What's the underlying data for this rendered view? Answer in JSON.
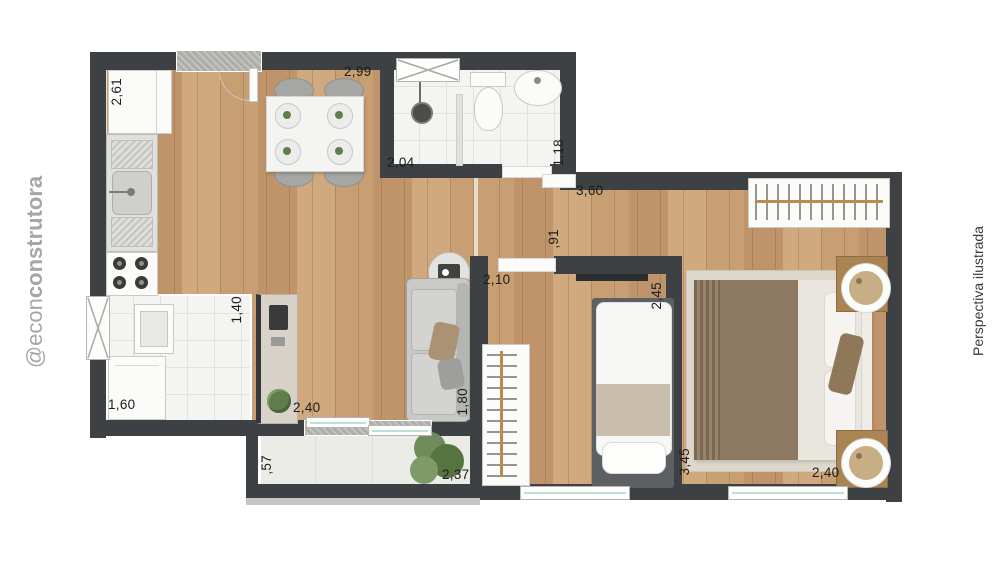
{
  "watermarks": {
    "left": {
      "prefix": "@econ",
      "bold": "construtora"
    },
    "right": "Perspectiva ilustrada"
  },
  "dimension_labels": [
    {
      "label": "2,61",
      "x": 109,
      "y": 78,
      "orientation": "vertical"
    },
    {
      "label": "2,99",
      "x": 344,
      "y": 64,
      "orientation": "horizontal"
    },
    {
      "label": "2,04",
      "x": 387,
      "y": 155,
      "orientation": "horizontal"
    },
    {
      "label": "1,18",
      "x": 551,
      "y": 139,
      "orientation": "vertical"
    },
    {
      "label": "3,60",
      "x": 576,
      "y": 183,
      "orientation": "horizontal"
    },
    {
      "label": ",91",
      "x": 546,
      "y": 229,
      "orientation": "vertical"
    },
    {
      "label": "2,10",
      "x": 483,
      "y": 272,
      "orientation": "horizontal"
    },
    {
      "label": "2,45",
      "x": 649,
      "y": 282,
      "orientation": "vertical"
    },
    {
      "label": "1,40",
      "x": 229,
      "y": 296,
      "orientation": "vertical"
    },
    {
      "label": "1,60",
      "x": 108,
      "y": 397,
      "orientation": "horizontal"
    },
    {
      "label": "2,40",
      "x": 293,
      "y": 400,
      "orientation": "horizontal"
    },
    {
      "label": "1,80",
      "x": 455,
      "y": 388,
      "orientation": "vertical"
    },
    {
      "label": ",57",
      "x": 259,
      "y": 455,
      "orientation": "vertical"
    },
    {
      "label": "2,37",
      "x": 442,
      "y": 467,
      "orientation": "horizontal"
    },
    {
      "label": "3,45",
      "x": 677,
      "y": 448,
      "orientation": "vertical"
    },
    {
      "label": "2,40",
      "x": 812,
      "y": 465,
      "orientation": "horizontal"
    }
  ],
  "colors": {
    "wall": "#3e4144",
    "wood_floor": "#c79f72",
    "tile_floor": "#f4f4f2",
    "balcony_floor": "#ebebe8",
    "fixture_white": "#fbfbfa",
    "glass_teal": "#bfe0da",
    "label_text": "#1c1c1c",
    "watermark_left": "#a6a6a6",
    "watermark_right": "#3a3a3a",
    "counter_beige": "#d9d2c8",
    "rug_beige": "#ded7cb",
    "sofa_gray": "#c9c9c7",
    "blanket_brown": "#8d7962",
    "blanket_beige": "#c9bdab",
    "furniture_wood": "#aa8453",
    "rail_gold": "#b98c4e",
    "plant_green": "#5f7d4d"
  }
}
